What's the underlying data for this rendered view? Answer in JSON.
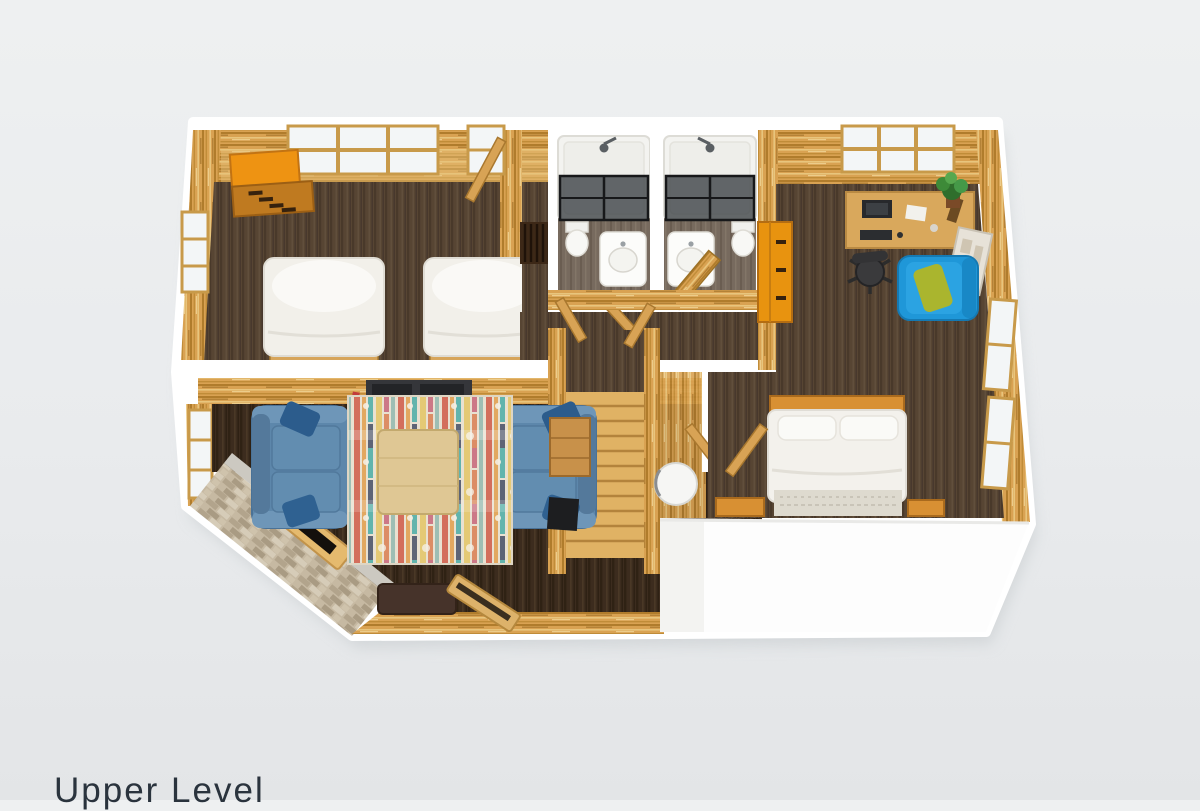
{
  "page": {
    "background_top": "#eef0f1",
    "background_bottom": "#e3e5e7"
  },
  "floorplan": {
    "label": "Upper Level",
    "label_color": "#2a333d",
    "palette": {
      "cut_wall_white": "#ffffff",
      "log_wall_wood": "#d9a252",
      "floor_dark_wood": "#574533",
      "floor_living_wood": "#3a2a1d",
      "bathroom_floor": "#776a5e",
      "stair_wood": "#e0b264",
      "sofa_blue": "#5d87ab",
      "armchair_blue": "#1f97d8",
      "pillow_olive": "#aab52e",
      "dresser_orange": "#e8930f",
      "bedding_white": "#f3f1ec",
      "rug_base": "#e9e1d1",
      "stone_wall": "#c6b9a2",
      "glass_dark": "#3a3f42"
    },
    "rooms": [
      {
        "name": "twin-bedroom",
        "furniture": [
          "dresser",
          "twin-bed",
          "twin-bed",
          "window",
          "window"
        ]
      },
      {
        "name": "hallway",
        "furniture": [
          "luggage-rack",
          "doors"
        ]
      },
      {
        "name": "bathroom-left",
        "furniture": [
          "bathtub-shower",
          "vanity-sink",
          "toilet",
          "door"
        ]
      },
      {
        "name": "bathroom-right",
        "furniture": [
          "bathtub-shower",
          "vanity-sink",
          "toilet",
          "door"
        ]
      },
      {
        "name": "staircase",
        "furniture": [
          "stairs",
          "landing"
        ]
      },
      {
        "name": "water-closet",
        "furniture": [
          "round-table",
          "door"
        ]
      },
      {
        "name": "master-bedroom",
        "furniture": [
          "desk",
          "office-chair",
          "potted-plant",
          "picture-frame",
          "armchair",
          "chest",
          "double-bed",
          "nightstand",
          "nightstand",
          "windows"
        ]
      },
      {
        "name": "living-area",
        "furniture": [
          "media-console",
          "sofa",
          "sofa",
          "area-rug",
          "coffee-table",
          "fireplace",
          "ottoman",
          "bench",
          "side-table",
          "tv",
          "window"
        ]
      }
    ]
  }
}
